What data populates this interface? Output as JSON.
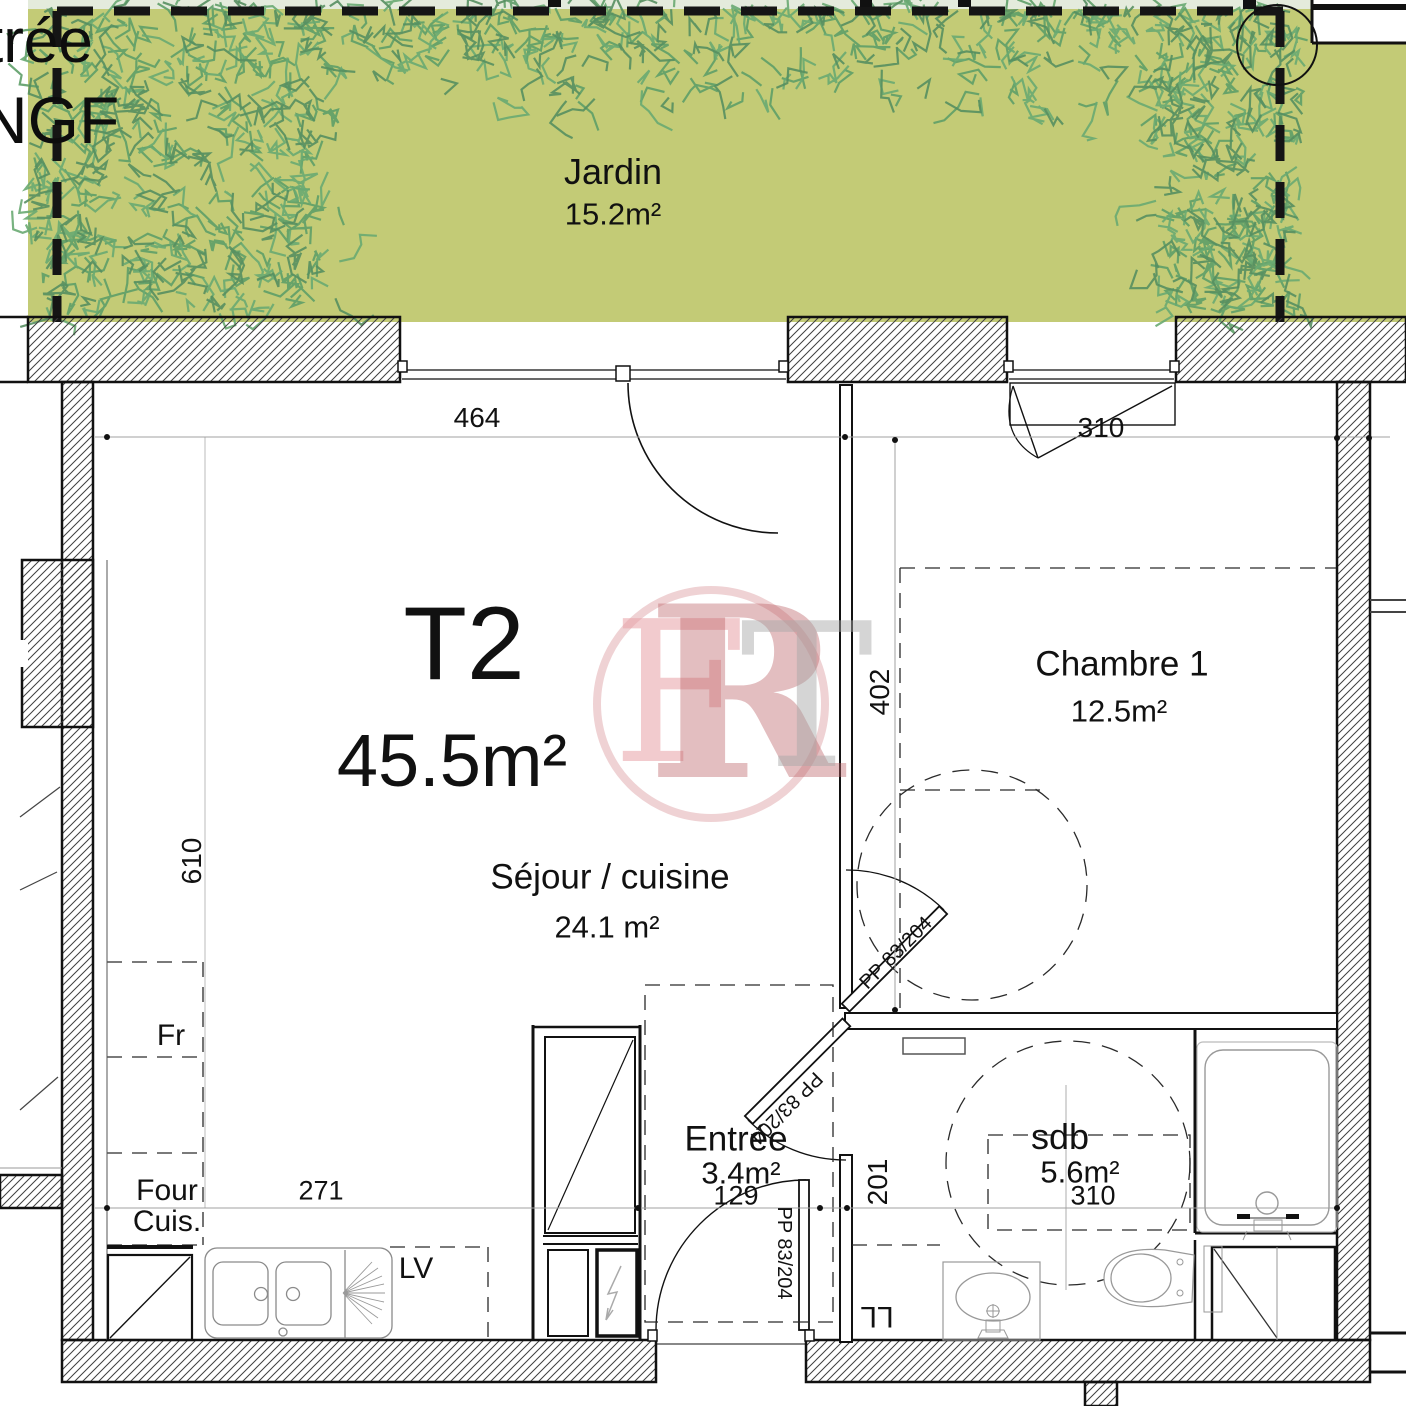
{
  "title_block": {
    "type_label": "T2",
    "total_area": "45.5m²"
  },
  "garden": {
    "label": "Jardin",
    "area": "15.2m²"
  },
  "edge_text": {
    "line1": "trée",
    "line2": "NGF"
  },
  "rooms": {
    "sejour": {
      "label": "Séjour / cuisine",
      "area": "24.1 m²"
    },
    "chambre": {
      "label": "Chambre 1",
      "area": "12.5m²"
    },
    "entree": {
      "label": "Entrée",
      "area": "3.4m²"
    },
    "sdb": {
      "label": "sdb",
      "area": "5.6m²"
    }
  },
  "dimensions": {
    "bay_window_width": "464",
    "chambre_window_width": "310",
    "chambre_depth": "402",
    "sejour_length": "610",
    "kitchen_run": "271",
    "entree_width": "129",
    "hall_depth": "201",
    "sdb_width": "310"
  },
  "appliances": {
    "fridge": "Fr",
    "oven": "Four",
    "hob": "Cuis.",
    "dishwasher": "LV",
    "washing_machine": "LL"
  },
  "doors": {
    "chambre_door": "PP 83/204",
    "sdb_door": "PP 83/204",
    "entrance_door": "PP 83/204"
  },
  "watermark": {
    "letter_left": "F",
    "letter_middle": "R",
    "letter_right": "T"
  },
  "colors": {
    "garden_green": "#c3cb76",
    "pale_strip": "#e4ebdc",
    "grass_green": "#5e9e68",
    "logo_red": "#c05d63",
    "logo_pink": "#e8aeb2",
    "logo_gray": "#b9b9b9"
  }
}
